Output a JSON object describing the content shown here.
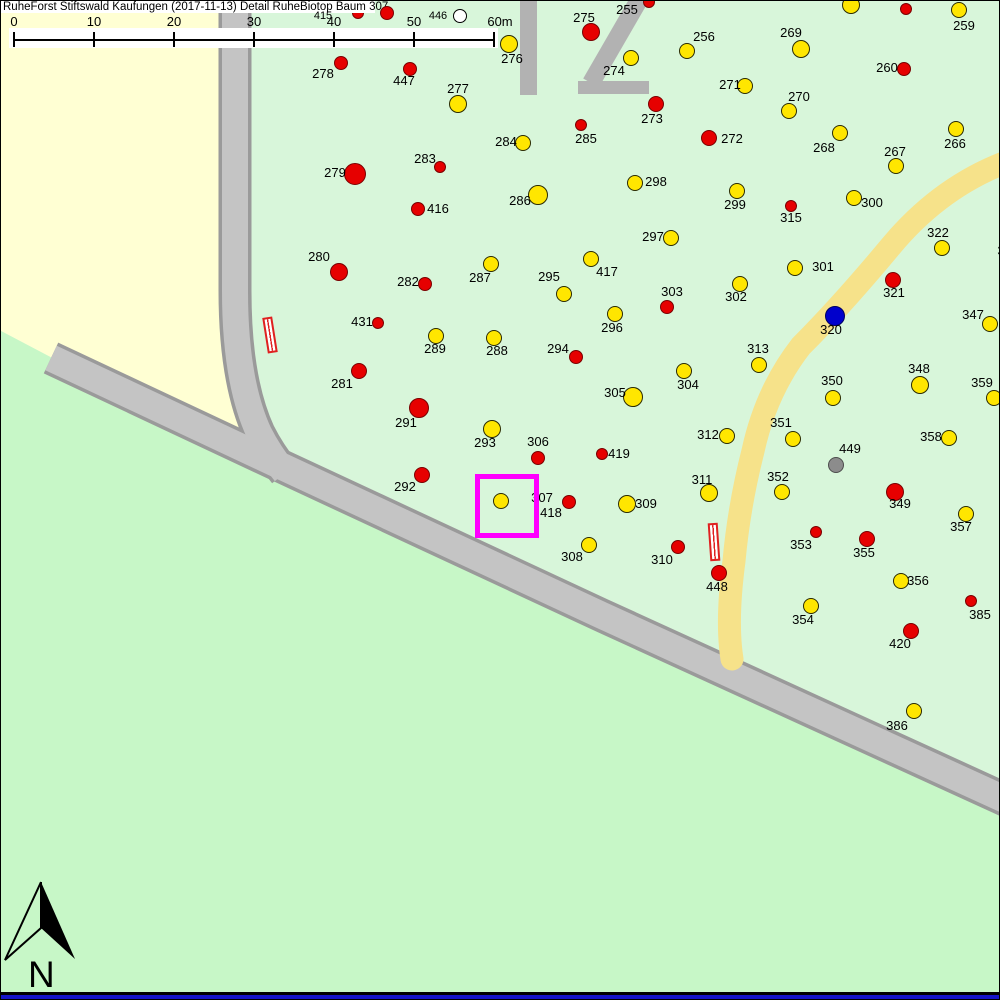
{
  "title": "RuheForst Stiftswald Kaufungen (2017-11-13) Detail  RuheBiotop Baum 307",
  "compartment_label": "12",
  "north_label": "N",
  "colors": {
    "forest_bg": "#d8f6da",
    "meadow_south": "#c7f7c7",
    "field_northwest": "#ffffd3",
    "road_fill": "#c4c4c4",
    "road_border": "#9a9a9a",
    "trail_yellow": "#f6e28a",
    "compartment_gray": "#b2b2b2",
    "selection_magenta": "#ff00ff",
    "marker_yellow": "#ffe600",
    "marker_red": "#e60000",
    "marker_blue": "#0000cc",
    "marker_gray": "#8c8c8c",
    "marker_white": "#ffffff",
    "bottom_bar_blue": "#1414c8"
  },
  "scale_bar": {
    "ticks": [
      {
        "label": "0",
        "x": 12
      },
      {
        "label": "10",
        "x": 92
      },
      {
        "label": "20",
        "x": 172
      },
      {
        "label": "30",
        "x": 252
      },
      {
        "label": "40",
        "x": 332
      },
      {
        "label": "50",
        "x": 412
      },
      {
        "label": "60m",
        "x": 492
      }
    ],
    "line_y": 38,
    "num_y": 13
  },
  "selection": {
    "tree": "307",
    "x": 474,
    "y": 473,
    "size": 54
  },
  "markers": [
    {
      "id": "415",
      "x": 357,
      "y": 12,
      "r": 6,
      "c": "red",
      "lx": 322,
      "ly": 9,
      "small": true,
      "under": true
    },
    {
      "id": "",
      "x": 386,
      "y": 12,
      "r": 7,
      "c": "red"
    },
    {
      "id": "446",
      "x": 459,
      "y": 15,
      "r": 7,
      "c": "white",
      "lx": 437,
      "ly": 9,
      "small": true
    },
    {
      "id": "255",
      "x": 648,
      "y": 1,
      "r": 6,
      "c": "red",
      "lx": 626,
      "ly": 2
    },
    {
      "id": "",
      "x": 850,
      "y": 4,
      "r": 9,
      "c": "yellow"
    },
    {
      "id": "",
      "x": 905,
      "y": 8,
      "r": 6,
      "c": "red"
    },
    {
      "id": "259",
      "x": 958,
      "y": 9,
      "r": 8,
      "c": "yellow",
      "lx": 963,
      "ly": 18
    },
    {
      "id": "275",
      "x": 590,
      "y": 31,
      "r": 9,
      "c": "red",
      "lx": 583,
      "ly": 10
    },
    {
      "id": "276",
      "x": 508,
      "y": 43,
      "r": 9,
      "c": "yellow",
      "lx": 511,
      "ly": 51
    },
    {
      "id": "256",
      "x": 686,
      "y": 50,
      "r": 8,
      "c": "yellow",
      "lx": 703,
      "ly": 29
    },
    {
      "id": "269",
      "x": 800,
      "y": 48,
      "r": 9,
      "c": "yellow",
      "lx": 790,
      "ly": 25
    },
    {
      "id": "274",
      "x": 630,
      "y": 57,
      "r": 8,
      "c": "yellow",
      "lx": 613,
      "ly": 63
    },
    {
      "id": "260",
      "x": 903,
      "y": 68,
      "r": 7,
      "c": "red",
      "lx": 886,
      "ly": 60
    },
    {
      "id": "278",
      "x": 340,
      "y": 62,
      "r": 7,
      "c": "red",
      "lx": 322,
      "ly": 66
    },
    {
      "id": "447",
      "x": 409,
      "y": 68,
      "r": 7,
      "c": "red",
      "lx": 403,
      "ly": 73
    },
    {
      "id": "271",
      "x": 744,
      "y": 85,
      "r": 8,
      "c": "yellow",
      "lx": 729,
      "ly": 77
    },
    {
      "id": "277",
      "x": 457,
      "y": 103,
      "r": 9,
      "c": "yellow",
      "lx": 457,
      "ly": 81
    },
    {
      "id": "273",
      "x": 655,
      "y": 103,
      "r": 8,
      "c": "red",
      "lx": 651,
      "ly": 111
    },
    {
      "id": "270",
      "x": 788,
      "y": 110,
      "r": 8,
      "c": "yellow",
      "lx": 798,
      "ly": 89
    },
    {
      "id": "285",
      "x": 580,
      "y": 124,
      "r": 6,
      "c": "red",
      "lx": 585,
      "ly": 131
    },
    {
      "id": "272",
      "x": 708,
      "y": 137,
      "r": 8,
      "c": "red",
      "lx": 731,
      "ly": 131
    },
    {
      "id": "268",
      "x": 839,
      "y": 132,
      "r": 8,
      "c": "yellow",
      "lx": 823,
      "ly": 140
    },
    {
      "id": "266",
      "x": 955,
      "y": 128,
      "r": 8,
      "c": "yellow",
      "lx": 954,
      "ly": 136
    },
    {
      "id": "284",
      "x": 522,
      "y": 142,
      "r": 8,
      "c": "yellow",
      "lx": 505,
      "ly": 134
    },
    {
      "id": "267",
      "x": 895,
      "y": 165,
      "r": 8,
      "c": "yellow",
      "lx": 894,
      "ly": 144
    },
    {
      "id": "283",
      "x": 439,
      "y": 166,
      "r": 6,
      "c": "red",
      "lx": 424,
      "ly": 151
    },
    {
      "id": "279",
      "x": 354,
      "y": 173,
      "r": 11,
      "c": "red",
      "lx": 334,
      "ly": 165
    },
    {
      "id": "298",
      "x": 634,
      "y": 182,
      "r": 8,
      "c": "yellow",
      "lx": 655,
      "ly": 174
    },
    {
      "id": "286",
      "x": 537,
      "y": 194,
      "r": 10,
      "c": "yellow",
      "lx": 519,
      "ly": 193
    },
    {
      "id": "299",
      "x": 736,
      "y": 190,
      "r": 8,
      "c": "yellow",
      "lx": 734,
      "ly": 197
    },
    {
      "id": "300",
      "x": 853,
      "y": 197,
      "r": 8,
      "c": "yellow",
      "lx": 871,
      "ly": 195
    },
    {
      "id": "315",
      "x": 790,
      "y": 205,
      "r": 6,
      "c": "red",
      "lx": 790,
      "ly": 210
    },
    {
      "id": "416",
      "x": 417,
      "y": 208,
      "r": 7,
      "c": "red",
      "lx": 437,
      "ly": 201
    },
    {
      "id": "322",
      "x": 941,
      "y": 247,
      "r": 8,
      "c": "yellow",
      "lx": 937,
      "ly": 225
    },
    {
      "id": "297",
      "x": 670,
      "y": 237,
      "r": 8,
      "c": "yellow",
      "lx": 652,
      "ly": 229
    },
    {
      "id": "3",
      "lx": 1000,
      "ly": 243
    },
    {
      "id": "280",
      "x": 338,
      "y": 271,
      "r": 9,
      "c": "red",
      "lx": 318,
      "ly": 249
    },
    {
      "id": "287",
      "x": 490,
      "y": 263,
      "r": 8,
      "c": "yellow",
      "lx": 479,
      "ly": 270
    },
    {
      "id": "417",
      "x": 590,
      "y": 258,
      "r": 8,
      "c": "yellow",
      "lx": 606,
      "ly": 264
    },
    {
      "id": "301",
      "x": 794,
      "y": 267,
      "r": 8,
      "c": "yellow",
      "lx": 822,
      "ly": 259
    },
    {
      "id": "282",
      "x": 424,
      "y": 283,
      "r": 7,
      "c": "red",
      "lx": 407,
      "ly": 274
    },
    {
      "id": "295",
      "x": 563,
      "y": 293,
      "r": 8,
      "c": "yellow",
      "lx": 548,
      "ly": 269
    },
    {
      "id": "303",
      "x": 666,
      "y": 306,
      "r": 7,
      "c": "red",
      "lx": 671,
      "ly": 284
    },
    {
      "id": "302",
      "x": 739,
      "y": 283,
      "r": 8,
      "c": "yellow",
      "lx": 735,
      "ly": 289
    },
    {
      "id": "321",
      "x": 892,
      "y": 279,
      "r": 8,
      "c": "red",
      "lx": 893,
      "ly": 285
    },
    {
      "id": "296",
      "x": 614,
      "y": 313,
      "r": 8,
      "c": "yellow",
      "lx": 611,
      "ly": 320
    },
    {
      "id": "320",
      "x": 834,
      "y": 315,
      "r": 10,
      "c": "blue",
      "lx": 830,
      "ly": 322
    },
    {
      "id": "347",
      "x": 989,
      "y": 323,
      "r": 8,
      "c": "yellow",
      "lx": 972,
      "ly": 307
    },
    {
      "id": "431",
      "x": 377,
      "y": 322,
      "r": 6,
      "c": "red",
      "lx": 361,
      "ly": 314
    },
    {
      "id": "289",
      "x": 435,
      "y": 335,
      "r": 8,
      "c": "yellow",
      "lx": 434,
      "ly": 341
    },
    {
      "id": "288",
      "x": 493,
      "y": 337,
      "r": 8,
      "c": "yellow",
      "lx": 496,
      "ly": 343
    },
    {
      "id": "313",
      "x": 758,
      "y": 364,
      "r": 8,
      "c": "yellow",
      "lx": 757,
      "ly": 341
    },
    {
      "id": "294",
      "x": 575,
      "y": 356,
      "r": 7,
      "c": "red",
      "lx": 557,
      "ly": 341
    },
    {
      "id": "304",
      "x": 683,
      "y": 370,
      "r": 8,
      "c": "yellow",
      "lx": 687,
      "ly": 377
    },
    {
      "id": "281",
      "x": 358,
      "y": 370,
      "r": 8,
      "c": "red",
      "lx": 341,
      "ly": 376
    },
    {
      "id": "305",
      "x": 632,
      "y": 396,
      "r": 10,
      "c": "yellow",
      "lx": 614,
      "ly": 385
    },
    {
      "id": "348",
      "x": 919,
      "y": 384,
      "r": 9,
      "c": "yellow",
      "lx": 918,
      "ly": 361
    },
    {
      "id": "350",
      "x": 832,
      "y": 397,
      "r": 8,
      "c": "yellow",
      "lx": 831,
      "ly": 373
    },
    {
      "id": "359",
      "x": 993,
      "y": 397,
      "r": 8,
      "c": "yellow",
      "lx": 981,
      "ly": 375
    },
    {
      "id": "291",
      "x": 418,
      "y": 407,
      "r": 10,
      "c": "red",
      "lx": 405,
      "ly": 415
    },
    {
      "id": "293",
      "x": 491,
      "y": 428,
      "r": 9,
      "c": "yellow",
      "lx": 484,
      "ly": 435
    },
    {
      "id": "312",
      "x": 726,
      "y": 435,
      "r": 8,
      "c": "yellow",
      "lx": 707,
      "ly": 427
    },
    {
      "id": "351",
      "x": 792,
      "y": 438,
      "r": 8,
      "c": "yellow",
      "lx": 780,
      "ly": 415
    },
    {
      "id": "358",
      "x": 948,
      "y": 437,
      "r": 8,
      "c": "yellow",
      "lx": 930,
      "ly": 429
    },
    {
      "id": "449",
      "x": 835,
      "y": 464,
      "r": 8,
      "c": "gray",
      "lx": 849,
      "ly": 441
    },
    {
      "id": "306",
      "x": 537,
      "y": 457,
      "r": 7,
      "c": "red",
      "lx": 537,
      "ly": 434
    },
    {
      "id": "419",
      "x": 601,
      "y": 453,
      "r": 6,
      "c": "red",
      "lx": 618,
      "ly": 446
    },
    {
      "id": "292",
      "x": 421,
      "y": 474,
      "r": 8,
      "c": "red",
      "lx": 404,
      "ly": 479
    },
    {
      "id": "311",
      "x": 708,
      "y": 492,
      "r": 9,
      "c": "yellow",
      "lx": 701,
      "ly": 472
    },
    {
      "id": "352",
      "x": 781,
      "y": 491,
      "r": 8,
      "c": "yellow",
      "lx": 777,
      "ly": 469
    },
    {
      "id": "349",
      "x": 894,
      "y": 491,
      "r": 9,
      "c": "red",
      "lx": 899,
      "ly": 496
    },
    {
      "id": "307",
      "x": 500,
      "y": 500,
      "r": 8,
      "c": "yellow",
      "lx": 541,
      "ly": 490
    },
    {
      "id": "418",
      "x": 568,
      "y": 501,
      "r": 7,
      "c": "red",
      "lx": 550,
      "ly": 505
    },
    {
      "id": "309",
      "x": 626,
      "y": 503,
      "r": 9,
      "c": "yellow",
      "lx": 645,
      "ly": 496
    },
    {
      "id": "357",
      "x": 965,
      "y": 513,
      "r": 8,
      "c": "yellow",
      "lx": 960,
      "ly": 519
    },
    {
      "id": "353",
      "x": 815,
      "y": 531,
      "r": 6,
      "c": "red",
      "lx": 800,
      "ly": 537
    },
    {
      "id": "355",
      "x": 866,
      "y": 538,
      "r": 8,
      "c": "red",
      "lx": 863,
      "ly": 545
    },
    {
      "id": "308",
      "x": 588,
      "y": 544,
      "r": 8,
      "c": "yellow",
      "lx": 571,
      "ly": 549
    },
    {
      "id": "310",
      "x": 677,
      "y": 546,
      "r": 7,
      "c": "red",
      "lx": 661,
      "ly": 552
    },
    {
      "id": "448",
      "x": 718,
      "y": 572,
      "r": 8,
      "c": "red",
      "lx": 716,
      "ly": 579
    },
    {
      "id": "356",
      "x": 900,
      "y": 580,
      "r": 8,
      "c": "yellow",
      "lx": 917,
      "ly": 573
    },
    {
      "id": "385",
      "x": 970,
      "y": 600,
      "r": 6,
      "c": "red",
      "lx": 979,
      "ly": 607
    },
    {
      "id": "354",
      "x": 810,
      "y": 605,
      "r": 8,
      "c": "yellow",
      "lx": 802,
      "ly": 612
    },
    {
      "id": "420",
      "x": 910,
      "y": 630,
      "r": 8,
      "c": "red",
      "lx": 899,
      "ly": 636
    },
    {
      "id": "386",
      "x": 913,
      "y": 710,
      "r": 8,
      "c": "yellow",
      "lx": 896,
      "ly": 718
    }
  ]
}
